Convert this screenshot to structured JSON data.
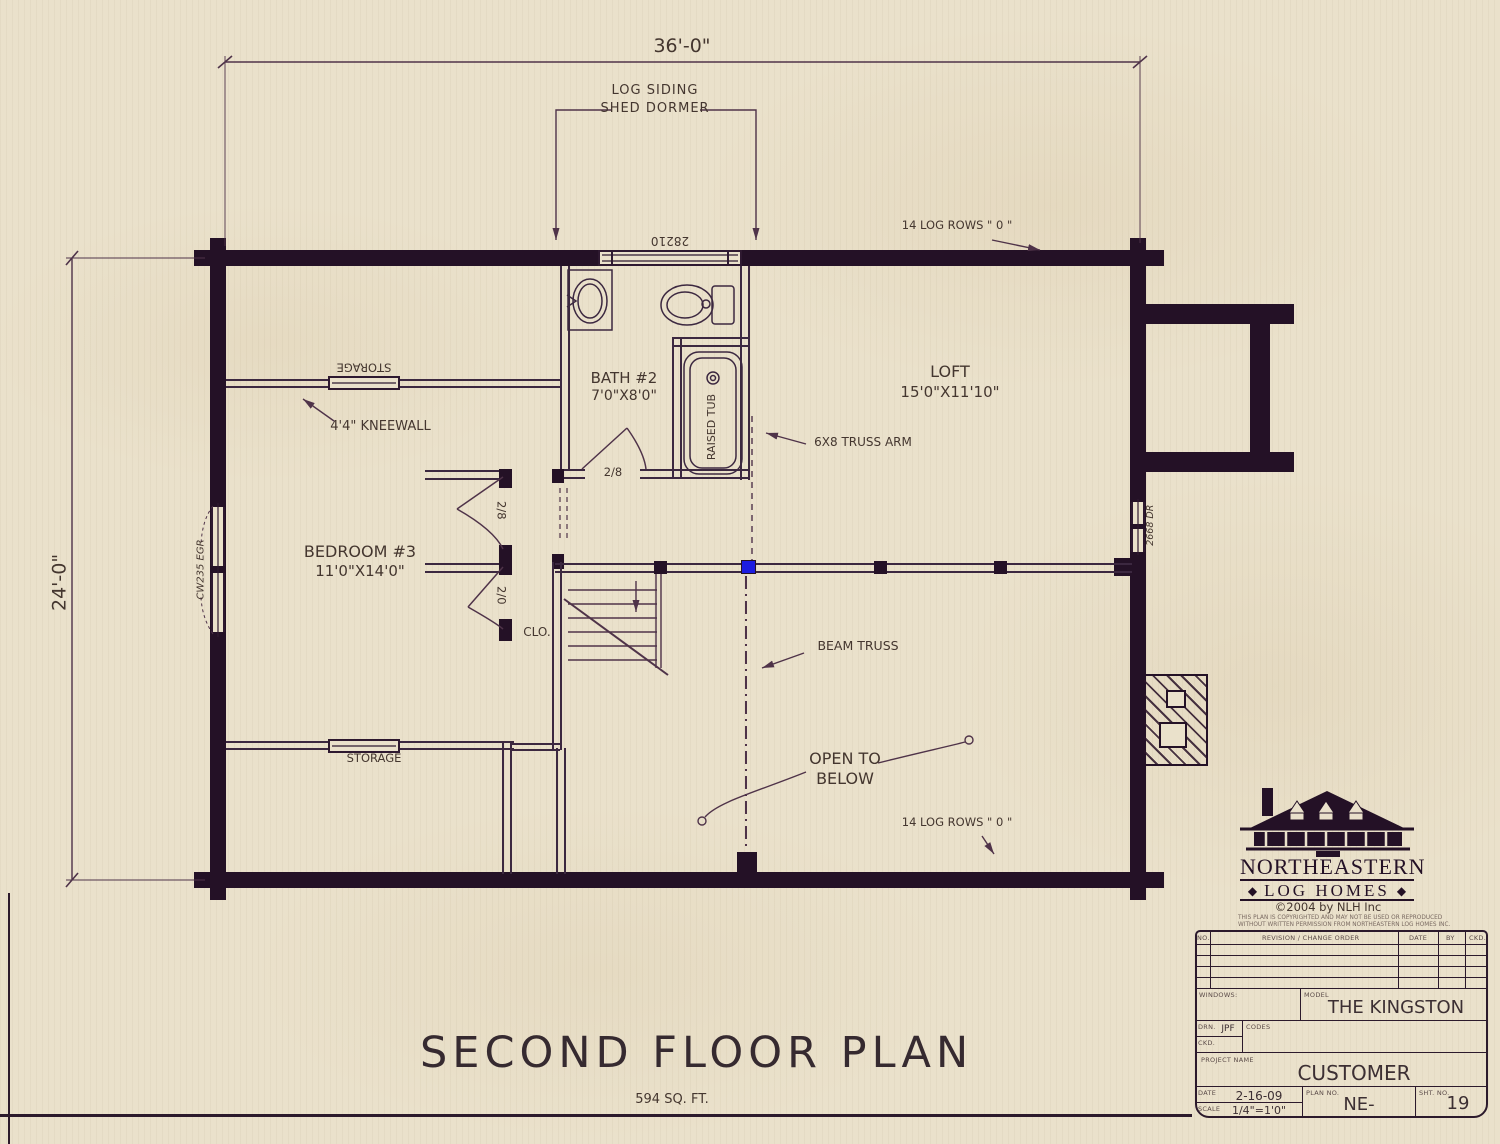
{
  "colors": {
    "paper": "#eae1cb",
    "ink": "#241126",
    "line": "#4f3349",
    "text": "#44362f",
    "accent_blue": "#1c1ce0"
  },
  "dims": {
    "top": "36'-0\"",
    "left": "24'-0\""
  },
  "ann": {
    "log_siding_1": "LOG SIDING",
    "log_siding_2": "SHED DORMER",
    "log_rows_top": "14 LOG ROWS \" 0 \"",
    "log_rows_bottom": "14 LOG ROWS \" 0 \"",
    "kneewall": "4'4\" KNEEWALL",
    "truss_arm": "6X8 TRUSS ARM",
    "beam_truss": "BEAM TRUSS",
    "open_1": "OPEN TO",
    "open_2": "BELOW",
    "storage_top": "STORAGE",
    "storage_bottom": "STORAGE",
    "clo": "CLO."
  },
  "rooms": {
    "bath": {
      "name": "BATH #2",
      "size": "7'0\"X8'0\""
    },
    "loft": {
      "name": "LOFT",
      "size": "15'0\"X11'10\""
    },
    "bedroom": {
      "name": "BEDROOM #3",
      "size": "11'0\"X14'0\""
    }
  },
  "fixtures": {
    "tub": "RAISED TUB"
  },
  "openings": {
    "dormer_window": "28210",
    "left_window": "CW235 EGR",
    "right_door": "2668 DR",
    "bath_door": "2/8",
    "bedroom_door": "2/8",
    "closet_door": "2/0"
  },
  "footer": {
    "title": "SECOND FLOOR PLAN",
    "area": "594 SQ. FT."
  },
  "logo": {
    "name_line1": "NORTHEASTERN",
    "name_line2": "LOG HOMES",
    "diamond": "◆",
    "copyright": "©2004 by NLH Inc",
    "fine_print_1": "THIS PLAN IS COPYRIGHTED AND MAY NOT BE USED OR REPRODUCED",
    "fine_print_2": "WITHOUT WRITTEN PERMISSION FROM NORTHEASTERN LOG HOMES INC."
  },
  "title_block": {
    "rev_headers": {
      "no": "NO.",
      "rev": "REVISION / CHANGE ORDER",
      "date": "DATE",
      "by": "BY",
      "ckd": "CKD."
    },
    "windows_label": "WINDOWS:",
    "model_label": "MODEL",
    "model_value": "THE KINGSTON",
    "drn_label": "DRN.",
    "drn_value": "JPF",
    "ckd_label": "CKD.",
    "codes_label": "CODES",
    "project_label": "PROJECT NAME",
    "project_value": "CUSTOMER",
    "date_label": "DATE",
    "date_value": "2-16-09",
    "scale_label": "SCALE",
    "scale_value": "1/4\"=1'0\"",
    "plan_no_label": "PLAN NO.",
    "plan_no_value": "NE-",
    "sheet_label": "SHT. NO.",
    "sheet_value": "19"
  }
}
